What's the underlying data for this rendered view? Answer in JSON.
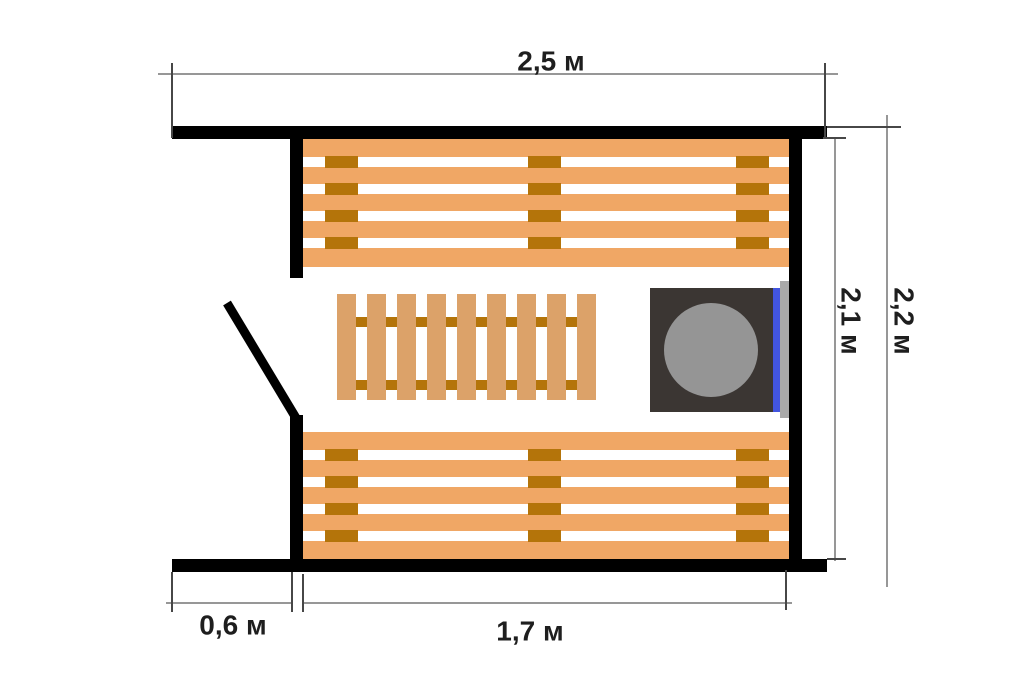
{
  "diagram": {
    "type": "sauna-floor-plan",
    "dimensions": {
      "width_total": {
        "label": "2,5 м"
      },
      "height_outer": {
        "label": "2,2 м"
      },
      "height_inner": {
        "label": "2,1 м"
      },
      "door_wall_offset": {
        "label": "0,6 м"
      },
      "bench_length": {
        "label": "1,7 м"
      }
    }
  },
  "colors": {
    "background": "#ffffff",
    "wall": "#000000",
    "bench_plank": "#F0A765",
    "bench_tie": "#B4740A",
    "duckboard_slat": "#DCA269",
    "duckboard_tie": "#B4740A",
    "stove_body": "#3B3633",
    "stove_top": "#959595",
    "screen_blue": "#4255DF",
    "ledge_gray": "#A9A9A9",
    "dimension_line": "#757575",
    "dimension_tick": "#474747",
    "label_text": "#1E1E1E"
  }
}
